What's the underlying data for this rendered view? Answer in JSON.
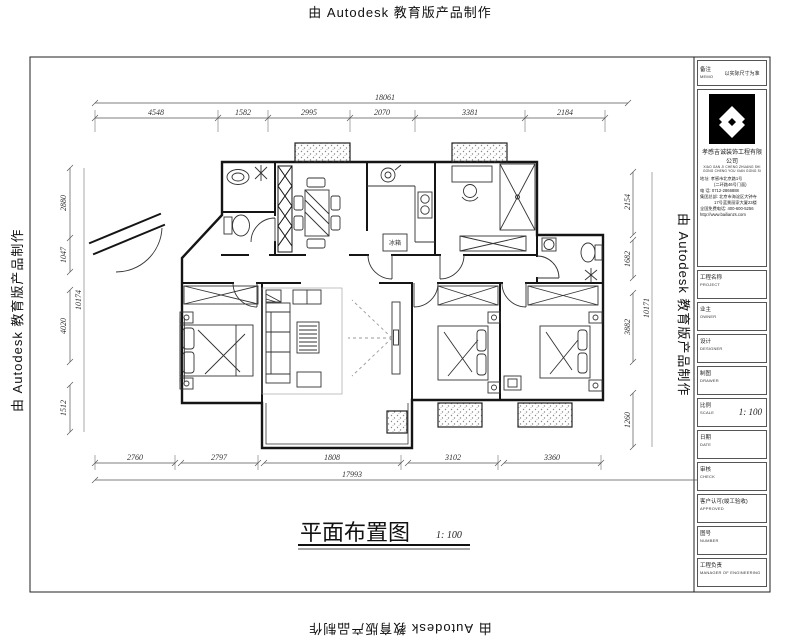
{
  "watermark": {
    "text": "由 Autodesk 教育版产品制作"
  },
  "drawing_title": {
    "text": "平面布置图",
    "scale": "1: 100"
  },
  "dimensions": {
    "top": {
      "total": "18061",
      "segments": [
        "4548",
        "1582",
        "2995",
        "2070",
        "3381",
        "2184"
      ]
    },
    "bottom": {
      "total": "17993",
      "segments": [
        "2760",
        "2797",
        "1808",
        "3102",
        "3360"
      ]
    },
    "left": {
      "total": "10174",
      "segments": [
        "2880",
        "1047",
        "4020",
        "1512"
      ]
    },
    "right": {
      "total": "10171",
      "segments": [
        "2154",
        "1682",
        "3882",
        "1260"
      ]
    }
  },
  "plan_labels": {
    "fridge": "冰箱"
  },
  "title_block": {
    "memo": {
      "zh": "备注",
      "en": "MEMO",
      "value": "以实际尺寸为准"
    },
    "company": {
      "name": "孝感吉诚装饰工程有限公司",
      "pinyin1": "XIAO GAN JI CHENG ZHUANG SHI",
      "pinyin2": "GONG CHENG YOU XIAN GONG SI",
      "address_label": "地址:",
      "address": "孝感市北京路1号",
      "address_note": "(二环路46号门面)",
      "phone_label": "电 话:",
      "phone": "0712-2866888",
      "hq_label": "集团总部:",
      "hq_line1": "北京市海淀区大钟寺",
      "hq_line2": "17号蓝景丽家大厦23楼",
      "hotline_label": "全国免费电话:",
      "hotline": "400-600-5256",
      "website": "http://www.bailianzs.com"
    },
    "fields": [
      {
        "zh": "工程名称",
        "en": "PROJECT",
        "value": ""
      },
      {
        "zh": "业主",
        "en": "OWNER",
        "value": ""
      },
      {
        "zh": "设计",
        "en": "DESIGNER",
        "value": ""
      },
      {
        "zh": "制图",
        "en": "DRAWER",
        "value": ""
      },
      {
        "zh": "比例",
        "en": "SCALE",
        "value": "1: 100"
      },
      {
        "zh": "日期",
        "en": "DATE",
        "value": ""
      },
      {
        "zh": "审核",
        "en": "CHECK",
        "value": ""
      },
      {
        "zh": "客户认可(竣工验收)",
        "en": "APPROVED",
        "value": ""
      },
      {
        "zh": "图号",
        "en": "NUMBER",
        "value": ""
      },
      {
        "zh": "工程负责",
        "en": "MANAGER OF ENGINEERING",
        "value": ""
      }
    ]
  }
}
